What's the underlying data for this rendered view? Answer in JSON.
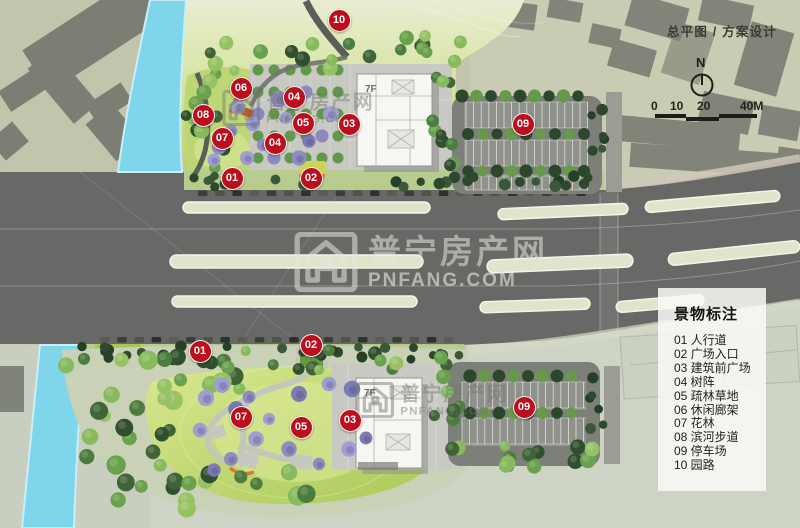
{
  "header": {
    "title": "总平图 / 方案设计"
  },
  "compass": {
    "north": "N"
  },
  "scale": {
    "labels": [
      "0",
      "10",
      "20",
      "40M"
    ]
  },
  "legend": {
    "title": "景物标注",
    "items": [
      {
        "num": "01",
        "label": "人行道"
      },
      {
        "num": "02",
        "label": "广场入口"
      },
      {
        "num": "03",
        "label": "建筑前广场"
      },
      {
        "num": "04",
        "label": "树阵"
      },
      {
        "num": "05",
        "label": "疏林草地"
      },
      {
        "num": "06",
        "label": "休闲廊架"
      },
      {
        "num": "07",
        "label": "花林"
      },
      {
        "num": "08",
        "label": "滨河步道"
      },
      {
        "num": "09",
        "label": "停车场"
      },
      {
        "num": "10",
        "label": "园路"
      }
    ]
  },
  "watermark": {
    "name": "普宁房产网",
    "domain": "PNFANG.COM"
  },
  "buildings": {
    "floor_label": "7F"
  },
  "plan": {
    "markers": [
      {
        "num": "10",
        "x": 339,
        "y": 20
      },
      {
        "num": "06",
        "x": 241,
        "y": 88
      },
      {
        "num": "04",
        "x": 294,
        "y": 97
      },
      {
        "num": "08",
        "x": 203,
        "y": 115
      },
      {
        "num": "05",
        "x": 303,
        "y": 123
      },
      {
        "num": "03",
        "x": 349,
        "y": 124
      },
      {
        "num": "09",
        "x": 523,
        "y": 124
      },
      {
        "num": "07",
        "x": 222,
        "y": 138
      },
      {
        "num": "04",
        "x": 275,
        "y": 143
      },
      {
        "num": "01",
        "x": 232,
        "y": 178
      },
      {
        "num": "02",
        "x": 311,
        "y": 178
      },
      {
        "num": "02",
        "x": 311,
        "y": 345
      },
      {
        "num": "01",
        "x": 200,
        "y": 351
      },
      {
        "num": "09",
        "x": 524,
        "y": 407
      },
      {
        "num": "07",
        "x": 241,
        "y": 417
      },
      {
        "num": "03",
        "x": 350,
        "y": 420
      },
      {
        "num": "05",
        "x": 301,
        "y": 427
      }
    ]
  },
  "colors": {
    "marker": "#bb0f1e",
    "road": "#686966",
    "river": "#7fd5ea",
    "lawn": "#b5d369",
    "legend_bg": "rgba(250,250,247,0.85)"
  }
}
